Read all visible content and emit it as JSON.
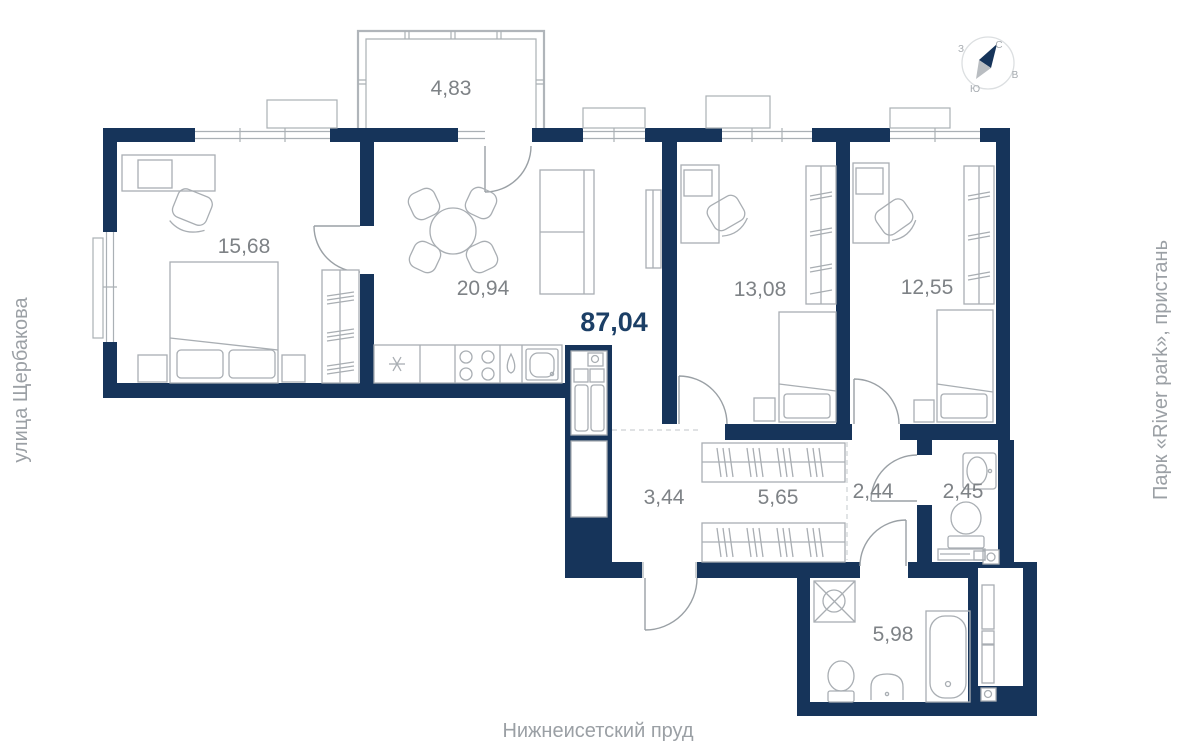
{
  "plan": {
    "total_area": "87,04",
    "rooms": [
      {
        "id": "balcony",
        "area": "4,83"
      },
      {
        "id": "bedroom",
        "area": "15,68"
      },
      {
        "id": "kitchen-living",
        "area": "20,94"
      },
      {
        "id": "bedroom-2",
        "area": "13,08"
      },
      {
        "id": "bedroom-3",
        "area": "12,55"
      },
      {
        "id": "corridor",
        "area": "3,44"
      },
      {
        "id": "hallway",
        "area": "5,65"
      },
      {
        "id": "hall",
        "area": "2,44"
      },
      {
        "id": "wc",
        "area": "2,45"
      },
      {
        "id": "bathroom",
        "area": "5,98"
      }
    ]
  },
  "surroundings": {
    "left": "улица Щербакова",
    "right": "Парк «River park», пристань",
    "bottom": "Нижнеисетский пруд"
  },
  "compass": {
    "north": "С",
    "south": "Ю",
    "east": "В",
    "west": "З"
  },
  "colors": {
    "wall": "#16345a",
    "total_label": "#1c3f66",
    "room_label": "#7e8286",
    "furniture": "#a9aeb3",
    "outside_label": "#9ba0a5"
  }
}
